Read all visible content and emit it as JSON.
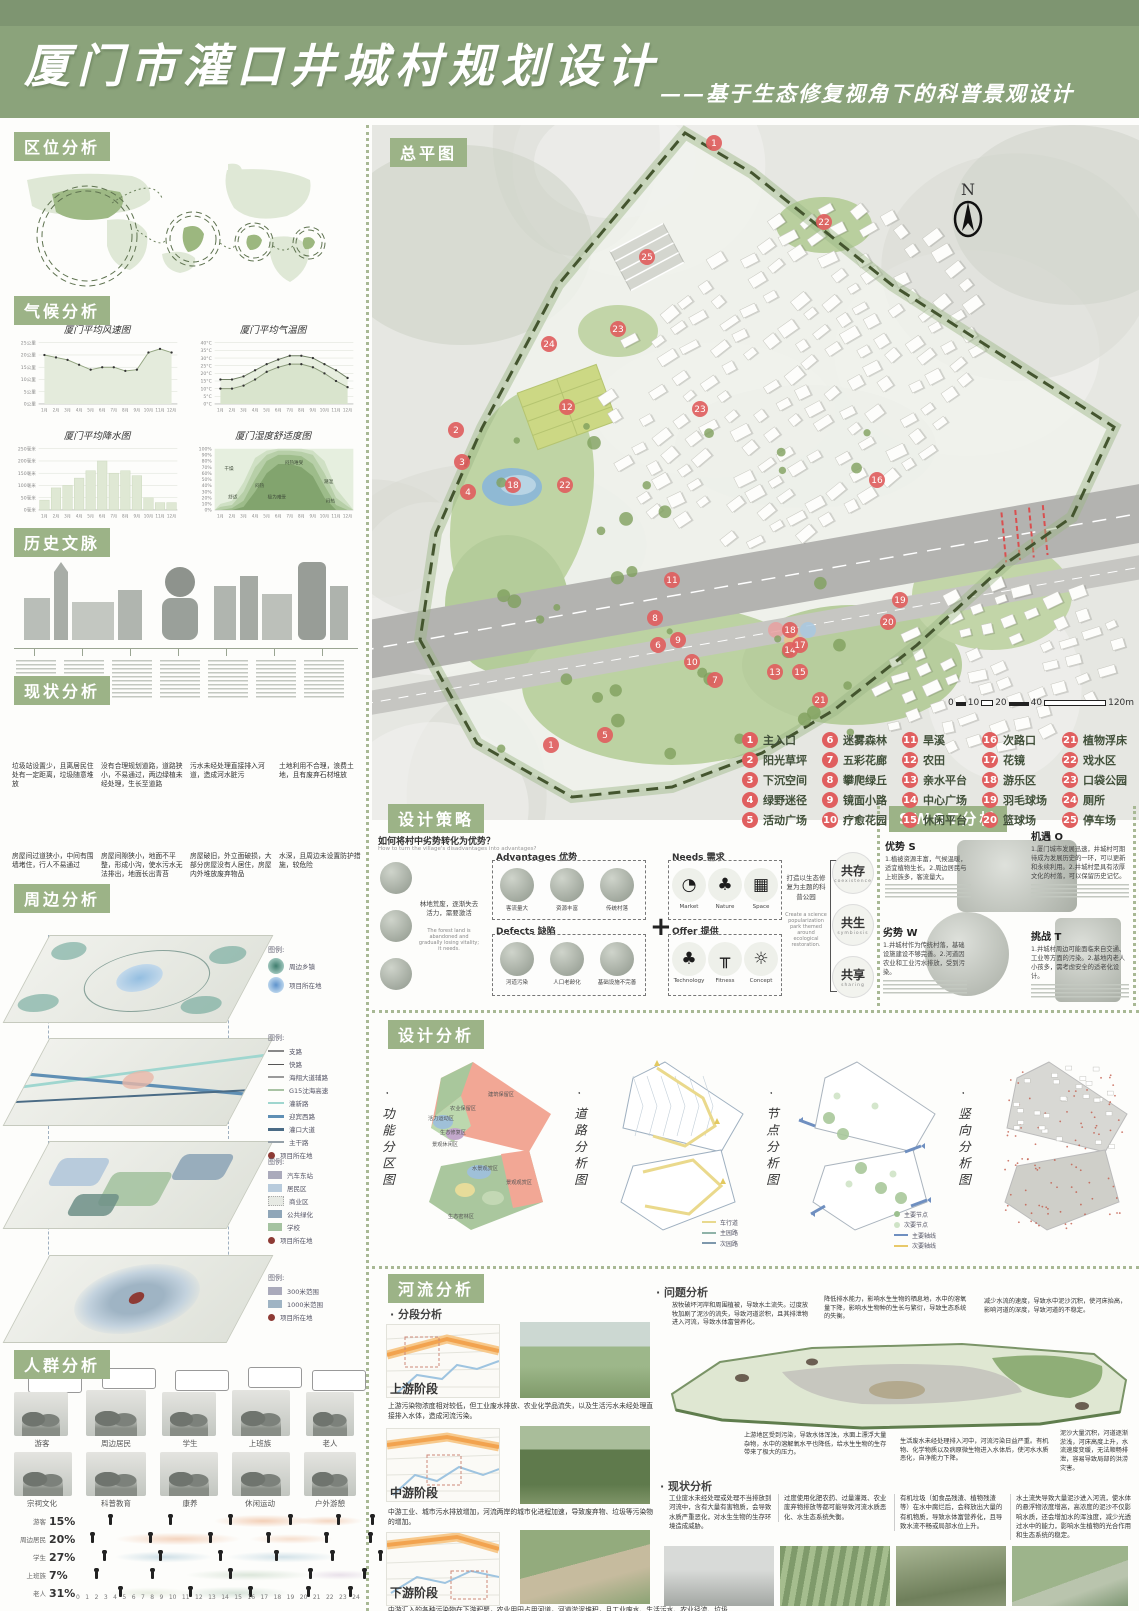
{
  "header": {
    "title": "厦门市灌口井城村规划设计",
    "subtitle": "——基于生态修复视角下的科普景观设计"
  },
  "labels": {
    "location": "区位分析",
    "climate": "气候分析",
    "history": "历史文脉",
    "current": "现状分析",
    "surrounding": "周边分析",
    "people": "人群分析",
    "masterplan": "总平图",
    "strategy": "设计策略",
    "swot": "SWOT分析",
    "design": "设计分析",
    "river": "河流分析"
  },
  "chart_data": [
    {
      "type": "line",
      "title": "厦门平均风速图",
      "x": [
        "1月",
        "2月",
        "3月",
        "4月",
        "5月",
        "6月",
        "7月",
        "8月",
        "9月",
        "10月",
        "11月",
        "12月"
      ],
      "values": [
        20,
        19,
        18,
        16,
        14,
        15,
        15,
        13.5,
        14,
        21,
        22.5,
        21
      ],
      "yticks": [
        "0公里",
        "5公里",
        "10公里",
        "15公里",
        "20公里",
        "25公里"
      ],
      "ylim": [
        0,
        25
      ],
      "grid": true
    },
    {
      "type": "line",
      "title": "厦门平均气温图",
      "x": [
        "1月",
        "2月",
        "3月",
        "4月",
        "5月",
        "6月",
        "7月",
        "8月",
        "9月",
        "10月",
        "11月",
        "12月"
      ],
      "series": [
        {
          "name": "平均最高气温",
          "values": [
            16,
            16,
            18,
            22,
            26,
            29,
            31.5,
            31.5,
            30,
            26,
            22,
            17
          ]
        },
        {
          "name": "平均最低气温",
          "values": [
            10,
            10,
            12,
            16,
            21,
            24,
            26,
            26,
            24,
            20,
            15,
            11
          ]
        }
      ],
      "yticks": [
        "0°C",
        "5°C",
        "10°C",
        "15°C",
        "20°C",
        "25°C",
        "30°C",
        "35°C",
        "40°C"
      ],
      "ylim": [
        0,
        40
      ],
      "grid": true
    },
    {
      "type": "bar",
      "title": "厦门平均降水图",
      "x": [
        "1月",
        "2月",
        "3月",
        "4月",
        "5月",
        "6月",
        "7月",
        "8月",
        "9月",
        "10月",
        "11月",
        "12月"
      ],
      "values": [
        40,
        90,
        100,
        130,
        160,
        200,
        150,
        160,
        140,
        50,
        30,
        30
      ],
      "yticks": [
        "0毫米",
        "50毫米",
        "100毫米",
        "150毫米",
        "200毫米",
        "250毫米"
      ],
      "ylim": [
        0,
        250
      ],
      "grid": true
    },
    {
      "type": "area",
      "title": "厦门湿度舒适度图",
      "x": [
        "1月",
        "2月",
        "3月",
        "4月",
        "5月",
        "6月",
        "7月",
        "8月",
        "9月",
        "10月",
        "11月",
        "12月"
      ],
      "zones": [
        "干燥",
        "舒适",
        "闷热",
        "极为难受",
        "闷热难受",
        "潮湿",
        "闷热"
      ],
      "yticks": [
        "0%",
        "10%",
        "20%",
        "30%",
        "40%",
        "50%",
        "60%",
        "70%",
        "80%",
        "90%",
        "100%"
      ],
      "ylim": [
        0,
        100
      ],
      "grid": false
    }
  ],
  "current": {
    "captions": [
      "垃圾站设置少，且离居民住处有一定距离，垃圾随意堆放",
      "没有合理规划道路，道路狭小，不易通过，两边绿植未经处理，生长至道路",
      "污水未经处理直接排入河道，造成河水脏污",
      "土地利用不合理，浪费土地，且有废弃石材堆放",
      "房屋间过道狭小，中间有围墙堵住，行人不易通过",
      "房屋间隙狭小，地面不平整，形成小沟，使水污水无法排出，地面长出青苔",
      "房屋破旧，外立面破损，大部分房屋没有人居住，房屋内外堆放废弃物品",
      "水深，且周边未设置防护措施，较危险"
    ]
  },
  "surrounding": {
    "legend_title": "图例:",
    "legend1": [
      {
        "label": "周边乡镇"
      },
      {
        "label": "项目所在地"
      }
    ],
    "legend2": {
      "items": [
        "支路",
        "快路",
        "海翔大道辅路",
        "G15沈海高速",
        "灌新路",
        "迎宾西路",
        "灌口大道",
        "主干路"
      ],
      "site": "项目所在地"
    },
    "legend3": {
      "items": [
        "汽车东站",
        "居民区",
        "商业区",
        "公共绿化",
        "学校"
      ],
      "site": "项目所在地"
    },
    "legend4": {
      "items": [
        "300米范围",
        "1000米范围"
      ],
      "site": "项目所在地"
    }
  },
  "people": {
    "groups": [
      "游客",
      "周边居民",
      "学生",
      "上班族",
      "老人"
    ],
    "activities": [
      "宗祠文化",
      "科普教育",
      "康养",
      "休闲运动",
      "户外游憩"
    ],
    "rows": [
      {
        "label": "游客",
        "pct": "15%"
      },
      {
        "label": "周边居民",
        "pct": "20%"
      },
      {
        "label": "学生",
        "pct": "27%"
      },
      {
        "label": "上班族",
        "pct": "7%"
      },
      {
        "label": "老人",
        "pct": "31%"
      }
    ],
    "hours": [
      "0",
      "1",
      "2",
      "3",
      "4",
      "5",
      "6",
      "7",
      "8",
      "9",
      "10",
      "11",
      "12",
      "13",
      "14",
      "15",
      "16",
      "17",
      "18",
      "19",
      "20",
      "21",
      "22",
      "23",
      "24"
    ]
  },
  "masterplan": {
    "north": "N",
    "scale": [
      "0",
      "10",
      "20",
      "40",
      "120m"
    ],
    "legend": [
      {
        "num": "1",
        "label": "主入口"
      },
      {
        "num": "2",
        "label": "阳光草坪"
      },
      {
        "num": "3",
        "label": "下沉空间"
      },
      {
        "num": "4",
        "label": "绿野迷径"
      },
      {
        "num": "5",
        "label": "活动广场"
      },
      {
        "num": "6",
        "label": "迷雾森林"
      },
      {
        "num": "7",
        "label": "五彩花廊"
      },
      {
        "num": "8",
        "label": "攀爬绿丘"
      },
      {
        "num": "9",
        "label": "镜面小路"
      },
      {
        "num": "10",
        "label": "疗愈花园"
      },
      {
        "num": "11",
        "label": "旱溪"
      },
      {
        "num": "12",
        "label": "农田"
      },
      {
        "num": "13",
        "label": "亲水平台"
      },
      {
        "num": "14",
        "label": "中心广场"
      },
      {
        "num": "15",
        "label": "休闲平台"
      },
      {
        "num": "16",
        "label": "次路口"
      },
      {
        "num": "17",
        "label": "花镜"
      },
      {
        "num": "18",
        "label": "游乐区"
      },
      {
        "num": "19",
        "label": "羽毛球场"
      },
      {
        "num": "20",
        "label": "篮球场"
      },
      {
        "num": "21",
        "label": "植物浮床"
      },
      {
        "num": "22",
        "label": "戏水区"
      },
      {
        "num": "23",
        "label": "口袋公园"
      },
      {
        "num": "24",
        "label": "厕所"
      },
      {
        "num": "25",
        "label": "停车场"
      }
    ]
  },
  "strategy": {
    "question": "如何将村中劣势转化为优势？",
    "question_en": "How to turn the village's disadvantages into advantages?",
    "left_note": "林地荒废，逐渐失去活力，需要激活",
    "left_note_en": "The forest land is abandoned and gradually losing vitality; it needs.",
    "advantages": {
      "title": "Advantages 优势",
      "items": [
        {
          "zh": "客流量大",
          "en": "Large passenger flow"
        },
        {
          "zh": "资源丰富",
          "en": "Rich resource base"
        },
        {
          "zh": "传统村落",
          "en": "Traditional village"
        }
      ]
    },
    "defects": {
      "title": "Defects 缺陷",
      "items": [
        {
          "zh": "河道污染",
          "en": "River pollution"
        },
        {
          "zh": "人口老龄化",
          "en": "Aging population"
        },
        {
          "zh": "基础设施不完善",
          "en": "Old facilities"
        }
      ]
    },
    "needs": {
      "title": "Needs 需求",
      "items": [
        {
          "zh": "市场",
          "en": "Market",
          "glyph": "◔"
        },
        {
          "zh": "自然",
          "en": "Nature",
          "glyph": "♣"
        },
        {
          "zh": "空间",
          "en": "Space",
          "glyph": "▦"
        }
      ]
    },
    "offer": {
      "title": "Offer 提供",
      "items": [
        {
          "zh": "科技",
          "en": "Technology",
          "glyph": "♣"
        },
        {
          "zh": "健身",
          "en": "Fitness",
          "glyph": "╥"
        },
        {
          "zh": "理念",
          "en": "Concept",
          "glyph": "☼"
        }
      ]
    },
    "plus": "+",
    "core": "打造以生态修复为主题的科普公园",
    "core_en": "Create a science popularization park themed around ecological restoration.",
    "goals": [
      {
        "zh": "共存",
        "en": "coexistence"
      },
      {
        "zh": "共生",
        "en": "symbiosis"
      },
      {
        "zh": "共享",
        "en": "sharing"
      }
    ]
  },
  "swot": {
    "items": [
      {
        "title": "优势 S",
        "text": "1.植被资源丰富，气候温暖，适宜植物生长。2.周边居民与上班族多，客流量大。"
      },
      {
        "title": "机遇 O",
        "text": "1.厦门城市发展迅速，井城村可期待成为发展历史的一环，可以更新和永续利用。2.井城村是具有浓厚文化的村落，可以保留历史记忆。"
      },
      {
        "title": "劣势 W",
        "text": "1.井城村作为传统村落，基础设施建设不够完善。2.河道因农业和工业污水排放，受到污染。"
      },
      {
        "title": "挑战 T",
        "text": "1.井城村周边可能面临来自交通、工业等方面的污染。2.基地内老人小孩多，需考虑安全的适老化设计。"
      }
    ]
  },
  "design": {
    "diagrams": [
      {
        "title": "· 功能分区图",
        "zones": [
          "建筑保留区",
          "农业保留区",
          "活力运动区",
          "生态修复区",
          "景观休闲区",
          "生态密林区",
          "水景观赏区",
          "景观观赏区"
        ]
      },
      {
        "title": "· 道路分析图",
        "legend": [
          "车行道",
          "主园路",
          "次园路"
        ]
      },
      {
        "title": "· 节点分析图",
        "legend": [
          "主要节点",
          "次要节点",
          "主要轴线",
          "次要轴线"
        ]
      },
      {
        "title": "· 竖向分析图"
      }
    ]
  },
  "river": {
    "seg_title": "· 分段分析",
    "prob_title": "· 问题分析",
    "status_title": "· 现状分析",
    "stages": [
      {
        "label": "上游阶段",
        "text": "上游污染物浓度相对较低，但工业废水排放、农业化学品流失，以及生活污水未经处理直接排入水体，造成河流污染。"
      },
      {
        "label": "中游阶段",
        "text": "中游工业、城市污水排放增加，河流两岸的城市化进程加速，导致废弃物、垃圾等污染物的增加。"
      },
      {
        "label": "下游阶段",
        "text": "中游汇入的各种污染物在下游积聚，农业用田占用河道，河道淤泥堆积，且工业废水、生活污水、农业径流、垃圾以及重金属污染等问题较为严重。"
      }
    ],
    "problems": [
      "放牧破坏河岸和周围植被，导致水土流失。过度放牧加剧了泥沙的流失，导致河道淤积，且其排泄物进入河流，导致水体富营养化。",
      "降低排水能力，影响水生生物的栖息地，水中的溶氧量下降，影响水生物种的生长与繁衍，导致生态系统的失衡。",
      "减少水流的速度，导致水中泥沙沉积，使河床抬高，影响河道的深度，导致河道的不稳定。",
      "上游地区受到污染，导致水体浑浊，水面上漂浮大量杂物，水中的溶解氧水平也降低，给水生生物的生存带来了极大的压力。",
      "生活废水未经处理排入河中，河流污染日益严重。有机物、化学物质以及病原微生物进入水体后，使河水水质恶化，自净能力下降。",
      "泥沙大量沉积，河道逐渐淤浅，河床高度上升，水流速度变缓，无法顺畅排泄，容易导致局部的洪涝灾害。"
    ],
    "statuses": [
      "工业废水未经处理或处理不当排放到河流中，含有大量有害物质，会导致水质严重恶化，对水生生物的生存环境造成威胁。",
      "过度使用化肥农药、过量灌溉、农业废弃物排放等都可能导致河流水质恶化、水生态系统失衡。",
      "有机垃圾（如食品残渣、植物残渣等）在水中腐烂后，会释放出大量的有机物质，导致水体富营养化，且导致水流不畅或局部水位上升。",
      "水土流失导致大量泥沙进入河流，使水体的悬浮物浓度增高，高浓度的泥沙不仅影响水质，还会增加水的浑浊度，减少光透过水中的能力，影响水生植物的光合作用和生态系统的稳定。"
    ]
  }
}
